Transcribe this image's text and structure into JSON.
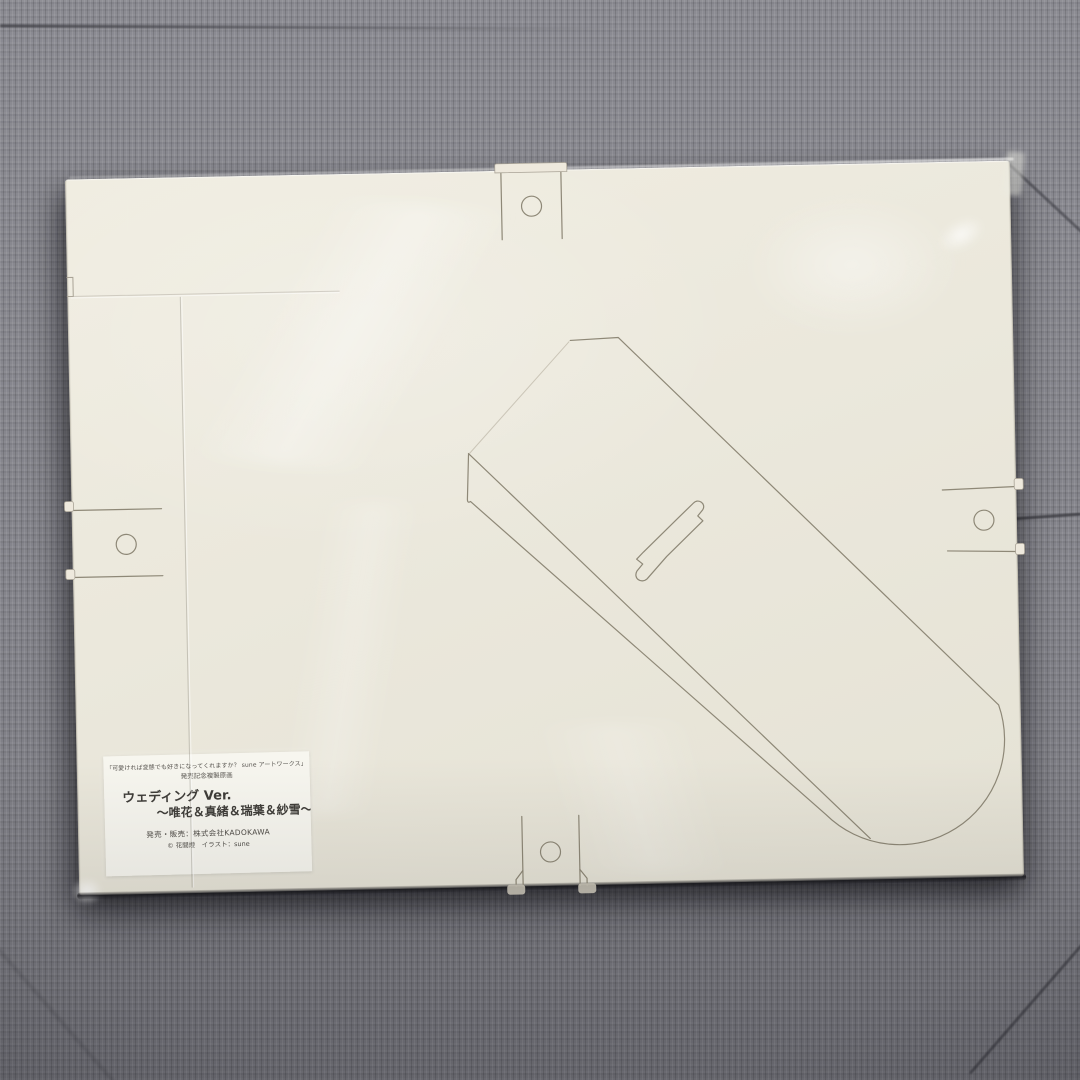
{
  "scene": {
    "type": "photograph",
    "subject": "Cream die-cut easel-back art board in clear plastic sleeve lying on gray ribbed carpet",
    "colors": {
      "carpet": "#83838a",
      "carpet_seam": "#3a3a40",
      "board": "#ebe8dc",
      "cut_line": "#8e8877",
      "label": "#f8f6f0",
      "shadow": "#16161a"
    }
  },
  "label": {
    "header_line1": "「可愛ければ変態でも好きになってくれますか？ sune アートワークス」",
    "header_line2": "発売記念複製原画",
    "title": "ウェディング Ver.",
    "subtitle": "～唯花＆真緒＆瑞葉＆紗雪～",
    "publisher": "発売・販売：株式会社KADOKAWA",
    "copyright": "© 花間燈　イラスト：sune"
  }
}
